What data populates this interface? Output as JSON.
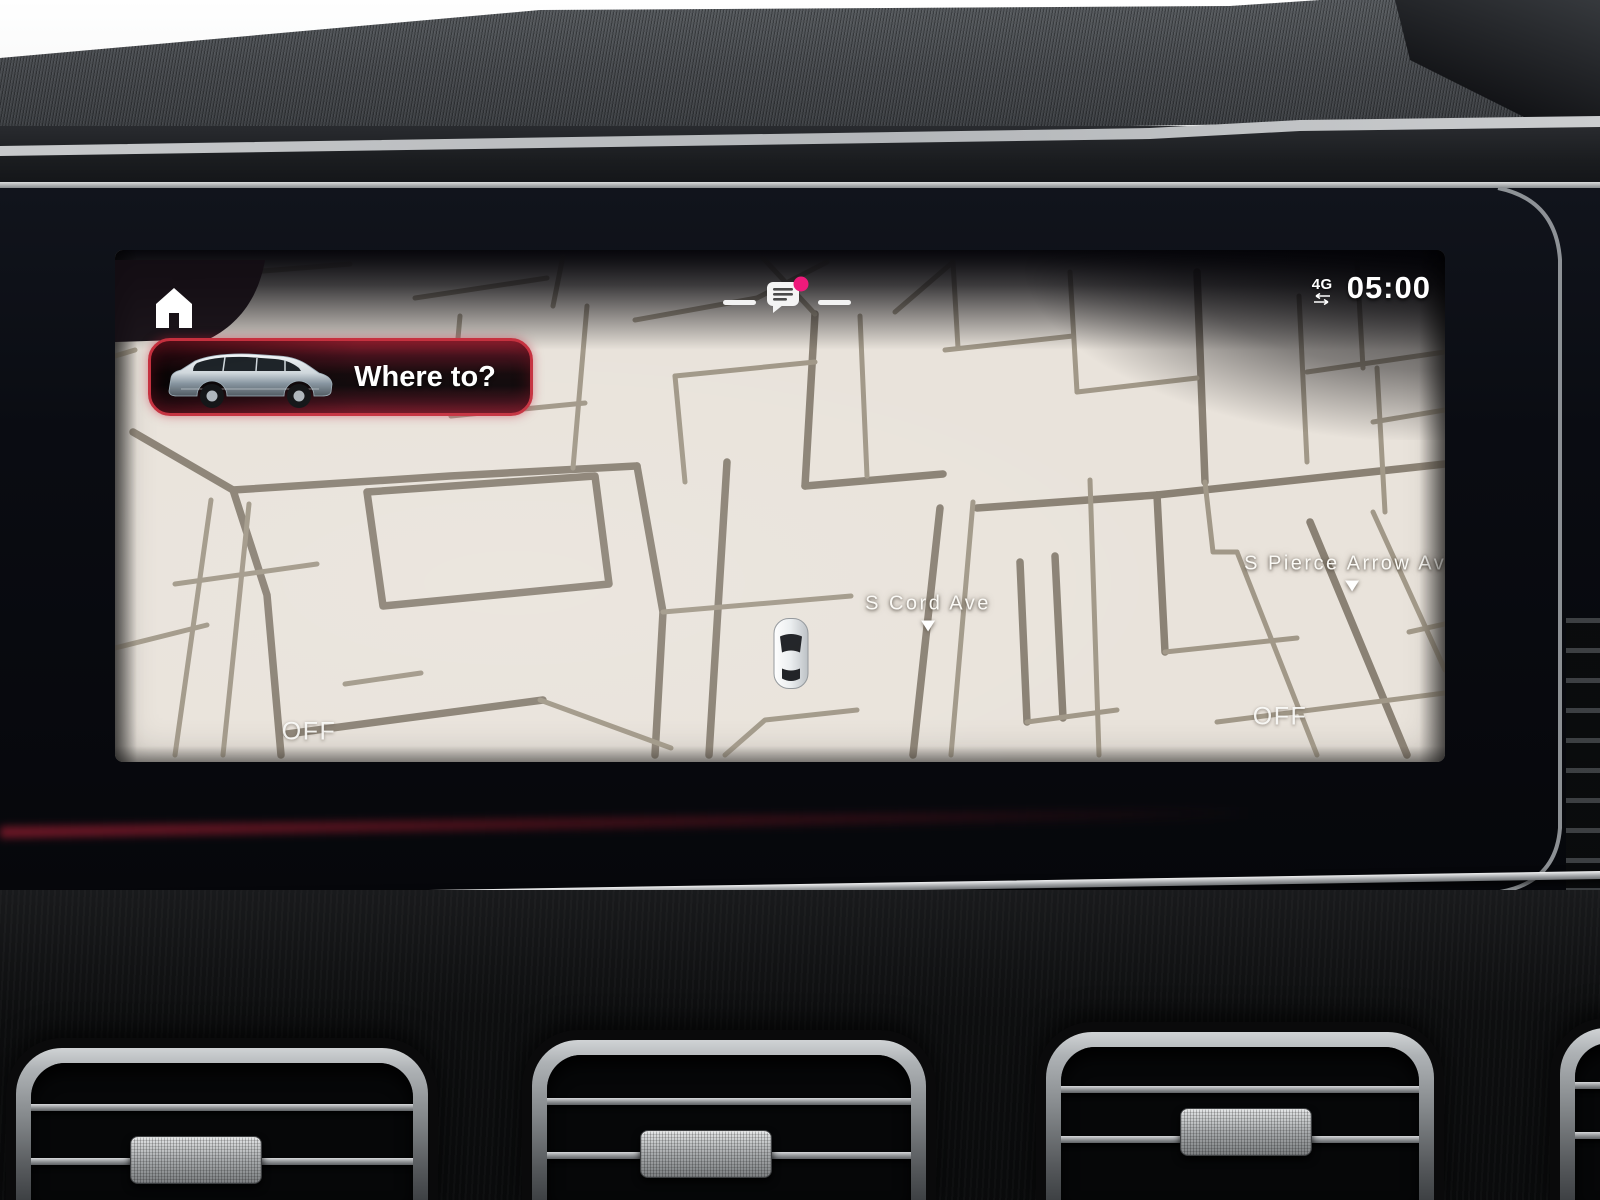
{
  "colors": {
    "accent_red": "#c5303e",
    "notification_pink": "#ef1a7b",
    "map_background": "#e9e3db",
    "road_main": "#8a8174",
    "road_minor": "#a19888",
    "screen_text": "#fbfaf6"
  },
  "status_bar": {
    "network": "4G",
    "network_icon": "data-transfer-arrows-icon",
    "time": "05:00"
  },
  "home": {
    "icon": "home-icon"
  },
  "where_to": {
    "label": "Where to?",
    "vehicle_image": "silver-suv-side-view"
  },
  "notification": {
    "icon": "message-bubble-icon",
    "badge": "unread-dot"
  },
  "map": {
    "vehicle": {
      "x": 676,
      "y": 406,
      "icon": "own-vehicle-top-view"
    },
    "street_labels": [
      {
        "text": "S Cord Ave",
        "x": 813,
        "y": 362
      },
      {
        "text": "S Pierce Arrow Ave",
        "x": 1237,
        "y": 322
      }
    ],
    "overlay_labels": [
      {
        "text": "OFF",
        "x": 194,
        "y": 482
      },
      {
        "text": "OFF",
        "x": 1165,
        "y": 467
      }
    ],
    "roads": [
      {
        "w": 2,
        "p": "18,182 118,240"
      },
      {
        "w": 2,
        "p": "118,240 152,345 166,505"
      },
      {
        "w": 2,
        "p": "118,240 335,226 522,216"
      },
      {
        "w": 2,
        "p": "172,484 428,450"
      },
      {
        "w": 2,
        "p": "252,242 480,226 494,334 268,356 252,242"
      },
      {
        "w": 2,
        "p": "522,216 548,362 540,505"
      },
      {
        "w": 2,
        "p": "612,212 594,505"
      },
      {
        "w": 2,
        "p": "700,64 690,236"
      },
      {
        "w": 2,
        "p": "690,236 828,224"
      },
      {
        "w": 2,
        "p": "825,258 798,505"
      },
      {
        "w": 2,
        "p": "862,258 1042,245"
      },
      {
        "w": 2,
        "p": "905,312 912,472"
      },
      {
        "w": 2,
        "p": "940,306 948,468"
      },
      {
        "w": 2,
        "p": "1042,245 1050,402"
      },
      {
        "w": 2,
        "p": "1042,245 1330,214"
      },
      {
        "w": 2,
        "p": "1195,272 1292,505"
      },
      {
        "w": 2,
        "p": "1082,22 1090,232"
      },
      {
        "w": 1,
        "p": "96,250 60,505"
      },
      {
        "w": 1,
        "p": "134,254 108,505"
      },
      {
        "w": 1,
        "p": "60,334 202,314"
      },
      {
        "w": 1,
        "p": "0,398 92,375"
      },
      {
        "w": 1,
        "p": "230,434 306,423"
      },
      {
        "w": 1,
        "p": "60,28 235,14"
      },
      {
        "w": 1,
        "p": "300,48 432,28"
      },
      {
        "w": 1,
        "p": "438,56 448,6"
      },
      {
        "w": 1,
        "p": "520,70 642,48"
      },
      {
        "w": 1,
        "p": "642,48 712,12"
      },
      {
        "w": 1,
        "p": "345,66 336,166"
      },
      {
        "w": 1,
        "p": "336,166 470,153"
      },
      {
        "w": 1,
        "p": "472,56 458,218"
      },
      {
        "w": 1,
        "p": "548,362 736,346"
      },
      {
        "w": 1,
        "p": "560,126 570,232"
      },
      {
        "w": 1,
        "p": "560,126 700,112"
      },
      {
        "w": 1,
        "p": "648,8 700,64"
      },
      {
        "w": 1,
        "p": "425,450 556,498"
      },
      {
        "w": 1,
        "p": "610,505 650,470 742,460"
      },
      {
        "w": 1,
        "p": "858,252 836,505"
      },
      {
        "w": 1,
        "p": "745,66 752,226"
      },
      {
        "w": 1,
        "p": "830,100 958,86"
      },
      {
        "w": 1,
        "p": "838,12 843,98"
      },
      {
        "w": 1,
        "p": "780,62 838,12"
      },
      {
        "w": 1,
        "p": "912,472 1002,460"
      },
      {
        "w": 1,
        "p": "975,230 984,505"
      },
      {
        "w": 1,
        "p": "1050,402 1182,388"
      },
      {
        "w": 1,
        "p": "1258,262 1330,420"
      },
      {
        "w": 1,
        "p": "1122,302 1202,505"
      },
      {
        "w": 1,
        "p": "1102,472 1330,443"
      },
      {
        "w": 1,
        "p": "955,22 962,142"
      },
      {
        "w": 1,
        "p": "962,142 1082,128"
      },
      {
        "w": 1,
        "p": "1184,46 1192,212"
      },
      {
        "w": 1,
        "p": "1192,122 1330,102"
      },
      {
        "w": 1,
        "p": "1242,12 1248,118"
      },
      {
        "w": 1,
        "p": "1262,118 1270,262"
      },
      {
        "w": 1,
        "p": "1258,172 1330,160"
      },
      {
        "w": 1,
        "p": "1294,382 1330,374"
      },
      {
        "w": 1,
        "p": "0,106 20,100"
      },
      {
        "w": 1,
        "p": "1090,232 1098,302 1122,302"
      }
    ]
  }
}
